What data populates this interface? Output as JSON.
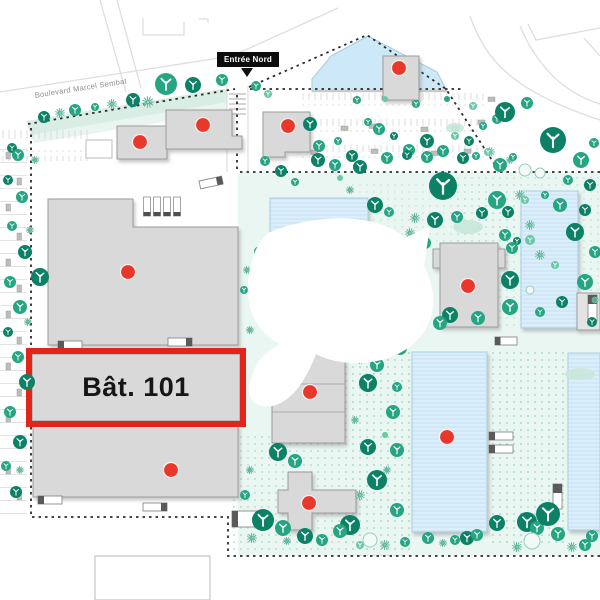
{
  "labels": {
    "building_highlight": "Bât. 101",
    "entrance_north": "Entrée Nord",
    "street": "Boulevard Marcel Sembat"
  },
  "map": {
    "width": 600,
    "height": 600,
    "colors": {
      "building_fill": "#d9d9d9",
      "building_stroke": "#9c9c9c",
      "blue_fill": "#dceefa",
      "blue_stripe": "#bfdff2",
      "blue_stroke": "#a9cfe2",
      "pond_fill": "#cde8f6",
      "pond_stroke": "#a5cbdf",
      "wash": "#eaf6f1",
      "strip_fill": "#d8eee5",
      "strip_fill2": "#e9f5f0",
      "dot_pattern": "#aeddc9",
      "marker": "#e8382c",
      "highlight": "#e0251b",
      "tree_dark": "#0c8166",
      "tree_mid": "#26a583",
      "tree_light": "#6ac8a5",
      "tree_outline": "#98cdbb",
      "tree_outline_fill": "#f2faf7",
      "burst": "#2f9f81",
      "burst_halo": "#ddf0e8",
      "blob": "#c9e7d9",
      "boundary": "#2b2b2b",
      "road": "#dedede",
      "stall": "#d6d6d6",
      "car": "#bdbdbd",
      "truck_fill": "#ffffff",
      "truck_stroke": "#8a8a8a",
      "truck_cab": "#5a5a5a",
      "dock_cap": "#4f4f4f",
      "outline_shape_stroke": "#c6c6c6",
      "apron": "#c9c9c9",
      "crosswalk": "#d4d4d4",
      "watermark": "#ffffff",
      "label_dark": "#161616"
    },
    "washes": [
      {
        "x": 238,
        "y": 172,
        "w": 362,
        "h": 384
      }
    ],
    "strip": {
      "points": "26,121 235,87 241,100 31,135",
      "points2": "31,135 241,100 244,109 34,143"
    },
    "dot_areas": [
      {
        "x": 345,
        "y": 352,
        "w": 67,
        "h": 204,
        "o": 1
      },
      {
        "x": 487,
        "y": 352,
        "w": 81,
        "h": 193,
        "o": 1
      },
      {
        "x": 452,
        "y": 176,
        "w": 148,
        "h": 152,
        "o": 0.55
      },
      {
        "x": 229,
        "y": 432,
        "w": 116,
        "h": 122,
        "o": 0.8
      },
      {
        "x": 352,
        "y": 182,
        "w": 175,
        "h": 66,
        "o": 0.45
      }
    ],
    "roads": [
      "M 0,92 L 232,56 L 338,8",
      "M 100,0 L 126,92",
      "M 117,0 L 141,88",
      "M 143,35 V 18 M 143,35 H 184 V 22",
      "M 199,19 H 208 V 23",
      "M 528,24 L 536,40 L 600,28",
      "M 584,38 L 600,56",
      "M 470,16 C 486,62 515,92 600,120",
      "M 520,26 C 536,64 562,92 600,104"
    ],
    "boundary": [
      "M 28,124 L 235,89",
      "M 237,95 V 170",
      "M 249,87 L 367,35 L 446,89 L 497,168",
      "M 250,89 H 462",
      "M 240,172 H 600",
      "M 31,128 V 517 H 228 V 556 H 600"
    ],
    "driveway": {
      "x": 227,
      "y": 86,
      "w": 21,
      "h": 86,
      "cross_y": [
        94,
        99,
        104,
        109,
        114
      ]
    },
    "parking_rows": [
      {
        "x": 302,
        "y": 93,
        "w": 186,
        "h": 13
      },
      {
        "x": 302,
        "y": 119,
        "w": 186,
        "h": 13
      },
      {
        "x": 302,
        "y": 145,
        "w": 186,
        "h": 13
      },
      {
        "x": 0,
        "y": 128,
        "w": 88,
        "h": 11
      },
      {
        "x": 0,
        "y": 150,
        "w": 88,
        "h": 11
      }
    ],
    "parking_col": {
      "x": 0,
      "y": 145,
      "w": 27,
      "h": 378
    },
    "cars": [
      [
        353,
        98
      ],
      [
        382,
        96
      ],
      [
        412,
        100
      ],
      [
        341,
        126
      ],
      [
        369,
        124
      ],
      [
        421,
        127
      ],
      [
        452,
        126
      ],
      [
        311,
        150
      ],
      [
        371,
        149
      ],
      [
        431,
        151
      ],
      [
        464,
        149
      ],
      [
        488,
        97
      ],
      [
        478,
        120
      ]
    ],
    "cars_v": [
      [
        6,
        152
      ],
      [
        17,
        178
      ],
      [
        6,
        204
      ],
      [
        17,
        233
      ],
      [
        6,
        259
      ],
      [
        17,
        285
      ],
      [
        6,
        311
      ],
      [
        17,
        337
      ],
      [
        6,
        363
      ],
      [
        17,
        389
      ],
      [
        6,
        415
      ],
      [
        17,
        441
      ],
      [
        6,
        467
      ],
      [
        17,
        493
      ]
    ],
    "pond": {
      "points": "312,91 312,79 331,56 368,36 437,72 447,91",
      "apron": "M 312,91 H 447"
    },
    "blue_buildings": [
      {
        "path": "M 270,198 H 368 V 232 H 270 Z"
      },
      {
        "path": "M 287,229 H 317 V 240 H 287 Z"
      },
      {
        "path": "M 317,230 H 353 V 241 H 317 Z"
      },
      {
        "path": "M 265,265 H 330 V 288 H 265 Z"
      },
      {
        "path": "M 521,191 H 578 V 328 H 521 Z"
      },
      {
        "path": "M 412,352 H 487 V 532 H 412 Z"
      },
      {
        "path": "M 568,353 H 600 V 530 H 568 Z"
      }
    ],
    "gray_buildings": [
      {
        "path": "M 117,126 H 167 V 159 H 117 Z"
      },
      {
        "path": "M 166,110 H 232 V 136 H 242 V 149 H 166 Z"
      },
      {
        "path": "M 263,112 H 310 V 152 H 285 V 157 H 263 Z"
      },
      {
        "path": "M 383,56 H 419 V 100 H 383 Z"
      },
      {
        "path": "M 48,199 H 133 V 227 H 238 V 345 H 48 Z"
      },
      {
        "path": "M 32,354 H 240 V 421 H 32 Z"
      },
      {
        "path": "M 33,425 H 238 V 497 H 33 Z"
      },
      {
        "path": "M 272,363 L 320,352 H 345 V 443 H 272 Z",
        "lines": [
          "M 272,384 H 345",
          "M 272,412 H 345"
        ]
      },
      {
        "path": "M 275,306 H 343 V 324 H 328 V 331 H 275 Z"
      },
      {
        "path": "M 440,243 H 498 V 327 H 440 Z M 433,249 H 440 V 268 H 433 Z M 498,249 H 505 V 268 H 498 Z"
      },
      {
        "path": "M 288,472 H 312 V 490 H 356 V 513 H 312 V 530 H 288 V 513 H 278 V 490 H 288 Z"
      },
      {
        "path": "M 577,293 H 600 V 330 H 577 Z",
        "fill": "#e3e3e3"
      }
    ],
    "outline_shapes": [
      {
        "path": "M 86,140 H 112 V 158 H 86 Z"
      },
      {
        "path": "M 95,556 H 210 V 600 H 95 Z"
      }
    ],
    "docks": [
      [
        143.5,
        197
      ],
      [
        153.5,
        197
      ],
      [
        163.5,
        197
      ],
      [
        173.5,
        197
      ]
    ],
    "trucks": [
      {
        "x": 58,
        "y": 341,
        "w": 24,
        "h": 8,
        "cab": "l"
      },
      {
        "x": 168,
        "y": 338,
        "w": 24,
        "h": 8,
        "cab": "r"
      },
      {
        "x": 199,
        "y": 181,
        "w": 23,
        "h": 8,
        "cab": "r",
        "rot": -12
      },
      {
        "x": 38,
        "y": 496,
        "w": 24,
        "h": 8,
        "cab": "l"
      },
      {
        "x": 143,
        "y": 503,
        "w": 24,
        "h": 8,
        "cab": "r"
      },
      {
        "x": 495,
        "y": 337,
        "w": 22,
        "h": 8,
        "cab": "l"
      },
      {
        "x": 489,
        "y": 432,
        "w": 24,
        "h": 8,
        "cab": "l"
      },
      {
        "x": 489,
        "y": 445,
        "w": 24,
        "h": 8,
        "cab": "l"
      },
      {
        "x": 553,
        "y": 484,
        "w": 9,
        "h": 25,
        "cab": "t"
      },
      {
        "x": 588,
        "y": 295,
        "w": 9,
        "h": 26,
        "cab": "t"
      },
      {
        "x": 232,
        "y": 511,
        "w": 27,
        "h": 16,
        "cab": "l"
      }
    ],
    "highlight": {
      "x": 29,
      "y": 351,
      "w": 214,
      "h": 73
    },
    "markers": [
      [
        140,
        142
      ],
      [
        203,
        125
      ],
      [
        288,
        126
      ],
      [
        399,
        68
      ],
      [
        128,
        272
      ],
      [
        171,
        470
      ],
      [
        310,
        392
      ],
      [
        309,
        503
      ],
      [
        468,
        286
      ],
      [
        447,
        437
      ]
    ],
    "watermark": {
      "path": "M 270,232 C 320,212 380,214 405,238 L 430,226 L 424,266 C 442,300 434,336 398,354 C 374,366 338,366 316,354 C 306,380 292,402 272,406 C 255,409 246,398 250,382 C 254,364 264,352 280,344 C 258,334 246,310 248,284 C 250,258 258,240 270,232 Z"
    },
    "trees": [
      [
        44,
        117,
        6,
        0
      ],
      [
        75,
        110,
        6,
        1
      ],
      [
        95,
        107,
        4,
        1
      ],
      [
        133,
        100,
        7,
        0
      ],
      [
        166,
        84,
        11,
        1
      ],
      [
        193,
        85,
        8,
        0
      ],
      [
        222,
        80,
        6,
        1
      ],
      [
        256,
        86,
        5,
        1
      ],
      [
        268,
        94,
        4,
        2
      ],
      [
        12,
        148,
        5,
        0
      ],
      [
        310,
        124,
        7,
        0
      ],
      [
        319,
        146,
        6,
        1
      ],
      [
        338,
        141,
        4,
        1
      ],
      [
        352,
        156,
        6,
        0
      ],
      [
        368,
        122,
        4,
        1
      ],
      [
        379,
        129,
        6,
        1
      ],
      [
        394,
        136,
        4,
        0
      ],
      [
        409,
        150,
        6,
        1
      ],
      [
        427,
        141,
        7,
        0
      ],
      [
        443,
        151,
        6,
        1
      ],
      [
        455,
        136,
        4,
        2
      ],
      [
        469,
        141,
        5,
        0
      ],
      [
        483,
        126,
        4,
        1
      ],
      [
        497,
        119,
        5,
        1
      ],
      [
        357,
        100,
        4,
        1
      ],
      [
        385,
        99,
        3,
        2
      ],
      [
        416,
        104,
        4,
        1
      ],
      [
        447,
        99,
        3,
        1
      ],
      [
        473,
        106,
        4,
        2
      ],
      [
        505,
        112,
        10,
        0
      ],
      [
        527,
        103,
        6,
        1
      ],
      [
        553,
        140,
        13,
        0
      ],
      [
        581,
        160,
        8,
        1
      ],
      [
        594,
        143,
        5,
        1
      ],
      [
        568,
        180,
        5,
        1
      ],
      [
        590,
        185,
        6,
        0
      ],
      [
        318,
        160,
        7,
        0
      ],
      [
        335,
        165,
        6,
        1
      ],
      [
        360,
        167,
        7,
        0
      ],
      [
        387,
        158,
        6,
        1
      ],
      [
        407,
        155,
        5,
        0
      ],
      [
        427,
        157,
        6,
        1
      ],
      [
        443,
        186,
        14,
        0
      ],
      [
        463,
        158,
        6,
        0
      ],
      [
        476,
        156,
        4,
        1
      ],
      [
        488,
        152,
        4,
        2
      ],
      [
        500,
        165,
        7,
        1
      ],
      [
        513,
        157,
        4,
        1
      ],
      [
        375,
        205,
        8,
        0
      ],
      [
        389,
        212,
        5,
        1
      ],
      [
        435,
        220,
        8,
        0
      ],
      [
        457,
        217,
        6,
        1
      ],
      [
        482,
        213,
        6,
        0
      ],
      [
        497,
        200,
        9,
        1
      ],
      [
        508,
        212,
        6,
        0
      ],
      [
        505,
        235,
        6,
        1
      ],
      [
        517,
        241,
        4,
        0
      ],
      [
        340,
        178,
        3,
        2
      ],
      [
        525,
        200,
        4,
        2
      ],
      [
        560,
        205,
        7,
        1
      ],
      [
        585,
        210,
        6,
        0
      ],
      [
        545,
        195,
        4,
        1
      ],
      [
        575,
        232,
        9,
        0
      ],
      [
        595,
        252,
        6,
        1
      ],
      [
        585,
        282,
        8,
        1
      ],
      [
        562,
        302,
        6,
        0
      ],
      [
        540,
        312,
        5,
        1
      ],
      [
        592,
        322,
        5,
        0
      ],
      [
        555,
        265,
        4,
        2
      ],
      [
        408,
        267,
        10,
        0
      ],
      [
        415,
        292,
        8,
        1
      ],
      [
        410,
        307,
        5,
        0
      ],
      [
        512,
        248,
        6,
        1
      ],
      [
        510,
        280,
        9,
        0
      ],
      [
        510,
        307,
        8,
        1
      ],
      [
        450,
        315,
        8,
        0
      ],
      [
        478,
        318,
        7,
        1
      ],
      [
        440,
        323,
        7,
        1
      ],
      [
        425,
        243,
        6,
        1
      ],
      [
        530,
        240,
        5,
        2
      ],
      [
        260,
        252,
        6,
        1
      ],
      [
        258,
        300,
        5,
        1
      ],
      [
        307,
        337,
        8,
        0
      ],
      [
        330,
        343,
        6,
        1
      ],
      [
        378,
        344,
        12,
        0
      ],
      [
        400,
        348,
        7,
        1
      ],
      [
        244,
        290,
        4,
        1
      ],
      [
        265,
        161,
        5,
        1
      ],
      [
        281,
        171,
        6,
        0
      ],
      [
        295,
        182,
        4,
        1
      ],
      [
        368,
        383,
        9,
        0
      ],
      [
        393,
        412,
        7,
        1
      ],
      [
        397,
        387,
        5,
        1
      ],
      [
        377,
        365,
        7,
        1
      ],
      [
        368,
        447,
        8,
        0
      ],
      [
        397,
        450,
        7,
        1
      ],
      [
        377,
        480,
        10,
        0
      ],
      [
        397,
        510,
        7,
        1
      ],
      [
        350,
        525,
        10,
        0
      ],
      [
        385,
        435,
        3,
        2
      ],
      [
        278,
        452,
        9,
        0
      ],
      [
        295,
        461,
        7,
        1
      ],
      [
        263,
        520,
        11,
        0
      ],
      [
        283,
        528,
        8,
        1
      ],
      [
        245,
        495,
        5,
        1
      ],
      [
        305,
        536,
        8,
        0
      ],
      [
        322,
        540,
        6,
        1
      ],
      [
        340,
        531,
        7,
        1
      ],
      [
        405,
        542,
        5,
        1
      ],
      [
        428,
        538,
        6,
        1
      ],
      [
        455,
        540,
        5,
        1
      ],
      [
        467,
        538,
        7,
        0
      ],
      [
        477,
        535,
        6,
        1
      ],
      [
        497,
        523,
        8,
        0
      ],
      [
        527,
        522,
        10,
        0
      ],
      [
        537,
        528,
        7,
        1
      ],
      [
        548,
        514,
        12,
        0
      ],
      [
        558,
        534,
        7,
        1
      ],
      [
        592,
        536,
        6,
        1
      ],
      [
        360,
        545,
        4,
        2
      ],
      [
        585,
        545,
        6,
        1
      ],
      [
        18,
        155,
        6,
        1
      ],
      [
        8,
        180,
        5,
        0
      ],
      [
        22,
        197,
        6,
        1
      ],
      [
        12,
        226,
        5,
        1
      ],
      [
        25,
        252,
        7,
        0
      ],
      [
        40,
        277,
        9,
        0
      ],
      [
        10,
        282,
        6,
        1
      ],
      [
        20,
        307,
        7,
        1
      ],
      [
        8,
        332,
        5,
        0
      ],
      [
        18,
        357,
        6,
        1
      ],
      [
        27,
        382,
        8,
        0
      ],
      [
        10,
        412,
        6,
        1
      ],
      [
        20,
        442,
        7,
        0
      ],
      [
        6,
        466,
        5,
        1
      ],
      [
        16,
        492,
        6,
        0
      ]
    ],
    "outline_trees": [
      [
        525,
        170,
        6
      ],
      [
        540,
        173,
        5
      ],
      [
        370,
        540,
        7
      ],
      [
        532,
        541,
        8
      ],
      [
        530,
        290,
        4
      ],
      [
        290,
        300,
        5
      ]
    ],
    "bursts": [
      [
        60,
        113,
        5
      ],
      [
        112,
        104,
        5
      ],
      [
        148,
        102,
        6
      ],
      [
        490,
        152,
        5
      ],
      [
        510,
        160,
        4
      ],
      [
        415,
        218,
        5
      ],
      [
        410,
        233,
        5
      ],
      [
        350,
        190,
        4
      ],
      [
        530,
        225,
        5
      ],
      [
        540,
        255,
        5
      ],
      [
        520,
        195,
        5
      ],
      [
        595,
        300,
        4
      ],
      [
        247,
        270,
        4
      ],
      [
        250,
        330,
        4
      ],
      [
        360,
        318,
        4
      ],
      [
        360,
        360,
        4
      ],
      [
        355,
        420,
        4
      ],
      [
        360,
        495,
        5
      ],
      [
        387,
        470,
        4
      ],
      [
        252,
        538,
        5
      ],
      [
        287,
        541,
        4
      ],
      [
        250,
        470,
        4
      ],
      [
        385,
        545,
        5
      ],
      [
        443,
        543,
        4
      ],
      [
        517,
        547,
        5
      ],
      [
        572,
        547,
        5
      ],
      [
        30,
        230,
        4
      ],
      [
        28,
        322,
        4
      ],
      [
        20,
        470,
        4
      ],
      [
        35,
        160,
        4
      ]
    ],
    "blobs": [
      [
        468,
        227,
        15,
        7
      ],
      [
        455,
        128,
        9,
        5
      ],
      [
        580,
        374,
        15,
        6
      ],
      [
        300,
        252,
        12,
        6
      ]
    ]
  }
}
